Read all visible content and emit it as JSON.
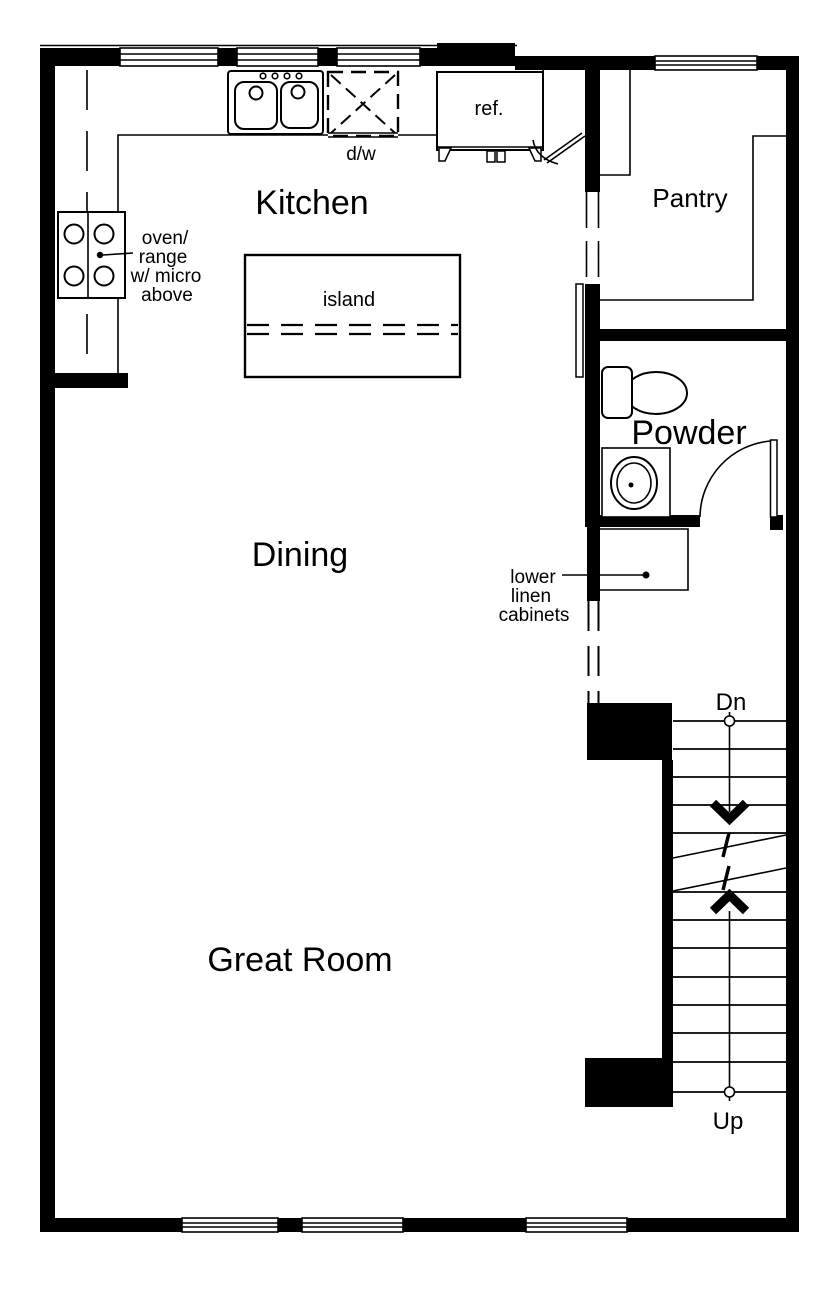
{
  "floor_plan": {
    "background_color": "#ffffff",
    "line_color": "#000000",
    "rooms": {
      "kitchen": {
        "label": "Kitchen"
      },
      "pantry": {
        "label": "Pantry"
      },
      "powder": {
        "label": "Powder"
      },
      "dining": {
        "label": "Dining"
      },
      "great_room": {
        "label": "Great Room"
      }
    },
    "fixtures": {
      "refrigerator": {
        "label": "ref."
      },
      "dishwasher": {
        "label": "d/w"
      },
      "island": {
        "label": "island"
      }
    },
    "annotations": {
      "range_note": {
        "lines": [
          "oven/",
          "range",
          "w/ micro",
          "above"
        ]
      },
      "linen_note": {
        "lines": [
          "lower",
          "linen",
          "cabinets"
        ]
      },
      "stairs": {
        "down": "Dn",
        "up": "Up"
      }
    }
  }
}
